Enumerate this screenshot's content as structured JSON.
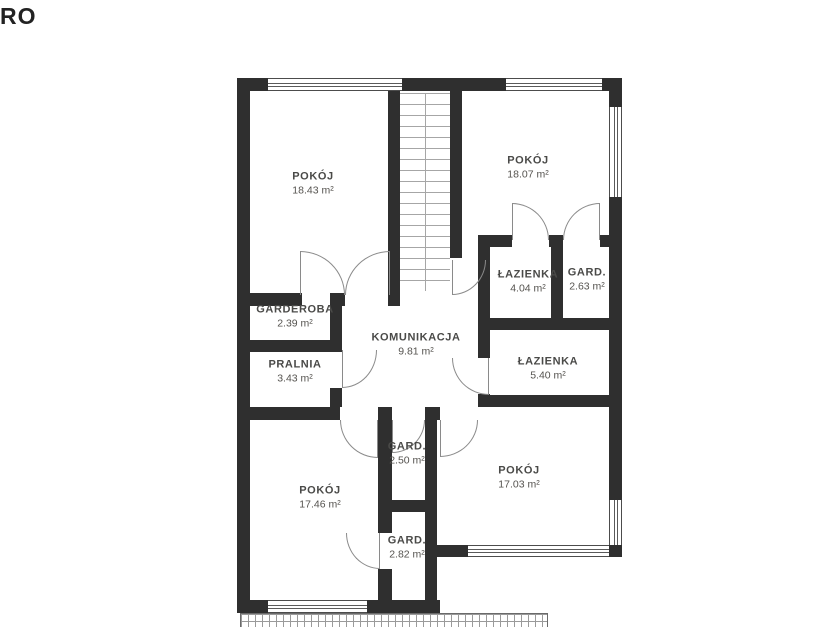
{
  "watermark": "RO",
  "rooms": [
    {
      "name": "POKÓJ",
      "area": "18.43 m²"
    },
    {
      "name": "POKÓJ",
      "area": "18.07 m²"
    },
    {
      "name": "ŁAZIENKA",
      "area": "4.04 m²"
    },
    {
      "name": "GARD.",
      "area": "2.63 m²"
    },
    {
      "name": "GARDEROBA",
      "area": "2.39 m²"
    },
    {
      "name": "KOMUNIKACJA",
      "area": "9.81 m²"
    },
    {
      "name": "PRALNIA",
      "area": "3.43 m²"
    },
    {
      "name": "ŁAZIENKA",
      "area": "5.40 m²"
    },
    {
      "name": "GARD.",
      "area": "2.50 m²"
    },
    {
      "name": "POKÓJ",
      "area": "17.46 m²"
    },
    {
      "name": "POKÓJ",
      "area": "17.03 m²"
    },
    {
      "name": "GARD.",
      "area": "2.82 m²"
    }
  ]
}
